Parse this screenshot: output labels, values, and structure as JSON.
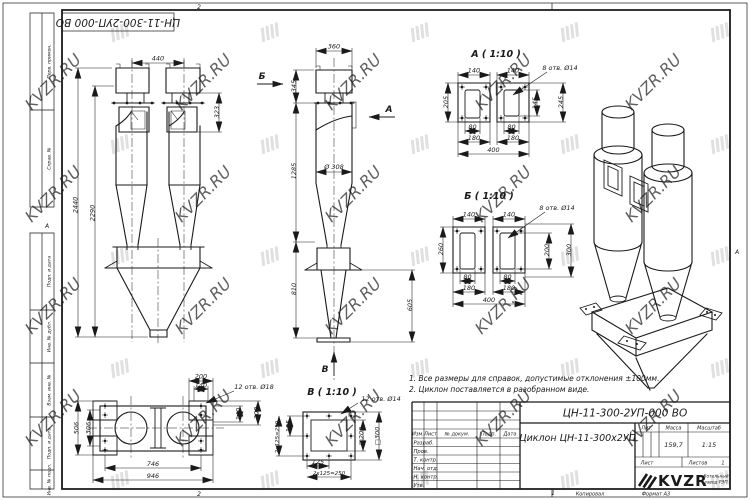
{
  "watermark": "KVZR.RU",
  "stamp_top": "ЦН-11-300-2УП-000 ВО",
  "notes": [
    "1. Все размеры для справок, допустимые отклонения ±100мм.",
    "2. Циклон поставляется в разобранном виде."
  ],
  "frame": {
    "labels": [
      "Перв. примен.",
      "Справ. №",
      "Подп. и дата",
      "Инв. № дубл.",
      "Взам. инв. №",
      "Подп. и дата",
      "Инв. № подл."
    ],
    "zone_top": "2",
    "zone_bottom": "2",
    "zone_bottom2": "1",
    "zone_left": "А",
    "zone_right": "А"
  },
  "views": {
    "front": {
      "d440": "440",
      "d2440": "2440",
      "d2290": "2290",
      "d323": "323"
    },
    "side": {
      "d360": "360",
      "d345": "345",
      "d1285": "1285",
      "d308": "Ø 308",
      "d810": "810",
      "d605": "605",
      "arrow_a": "А",
      "arrow_b": "Б",
      "arrow_v": "В"
    },
    "sec_a": {
      "title": "А ( 1:10 )",
      "holes": "8 отв. Ø14",
      "d140l": "140",
      "d140r": "140",
      "d205": "205",
      "d145": "145",
      "d245": "245",
      "d80l": "80",
      "d80r": "80",
      "d180l": "180",
      "d180r": "180",
      "d400": "400"
    },
    "sec_b": {
      "title": "Б ( 1:10 )",
      "holes": "8 отв. Ø14",
      "d140l": "140",
      "d140r": "140",
      "d260": "260",
      "d200": "200",
      "d300": "300",
      "d80l": "80",
      "d80r": "80",
      "d180l": "180",
      "d180r": "180",
      "d400": "400"
    },
    "top": {
      "holes": "12 отв. Ø18",
      "d200t": "200",
      "d140t": "140",
      "d140r": "140",
      "d200r": "200",
      "d306": "306",
      "d506": "506",
      "d746": "746",
      "d946": "946"
    },
    "sec_v": {
      "title": "В ( 1:10 )",
      "holes": "12 отв. Ø14",
      "d125l": "125",
      "d250l": "2х125=250",
      "d125b": "125",
      "d250b": "2х125=250",
      "sq200": "□200",
      "sq300": "□300"
    }
  },
  "title_block": {
    "doc_number": "ЦН-11-300-2УП-000 ВО",
    "product_name": "Циклон ЦН-11-300х2УП",
    "lit_label": "Лит.",
    "mass_label": "Масса",
    "scale_label": "Масштаб",
    "mass": "159,7",
    "scale": "1:15",
    "sheet_label": "Лист",
    "sheets_label": "Листов",
    "sheets": "1",
    "header": {
      "izm": "Изм.",
      "list": "Лист",
      "doc": "№ докум.",
      "podp": "Подп.",
      "data": "Дата"
    },
    "rows": [
      "Разраб.",
      "Пров.",
      "Т. контр.",
      "Нач. отд.",
      "Н. контр.",
      "Утв."
    ],
    "company_logo": "KVZR",
    "company_name1": "Котельный",
    "company_name2": "завод РЭП",
    "footer_copy": "Копировал",
    "footer_format": "Формат А3"
  }
}
